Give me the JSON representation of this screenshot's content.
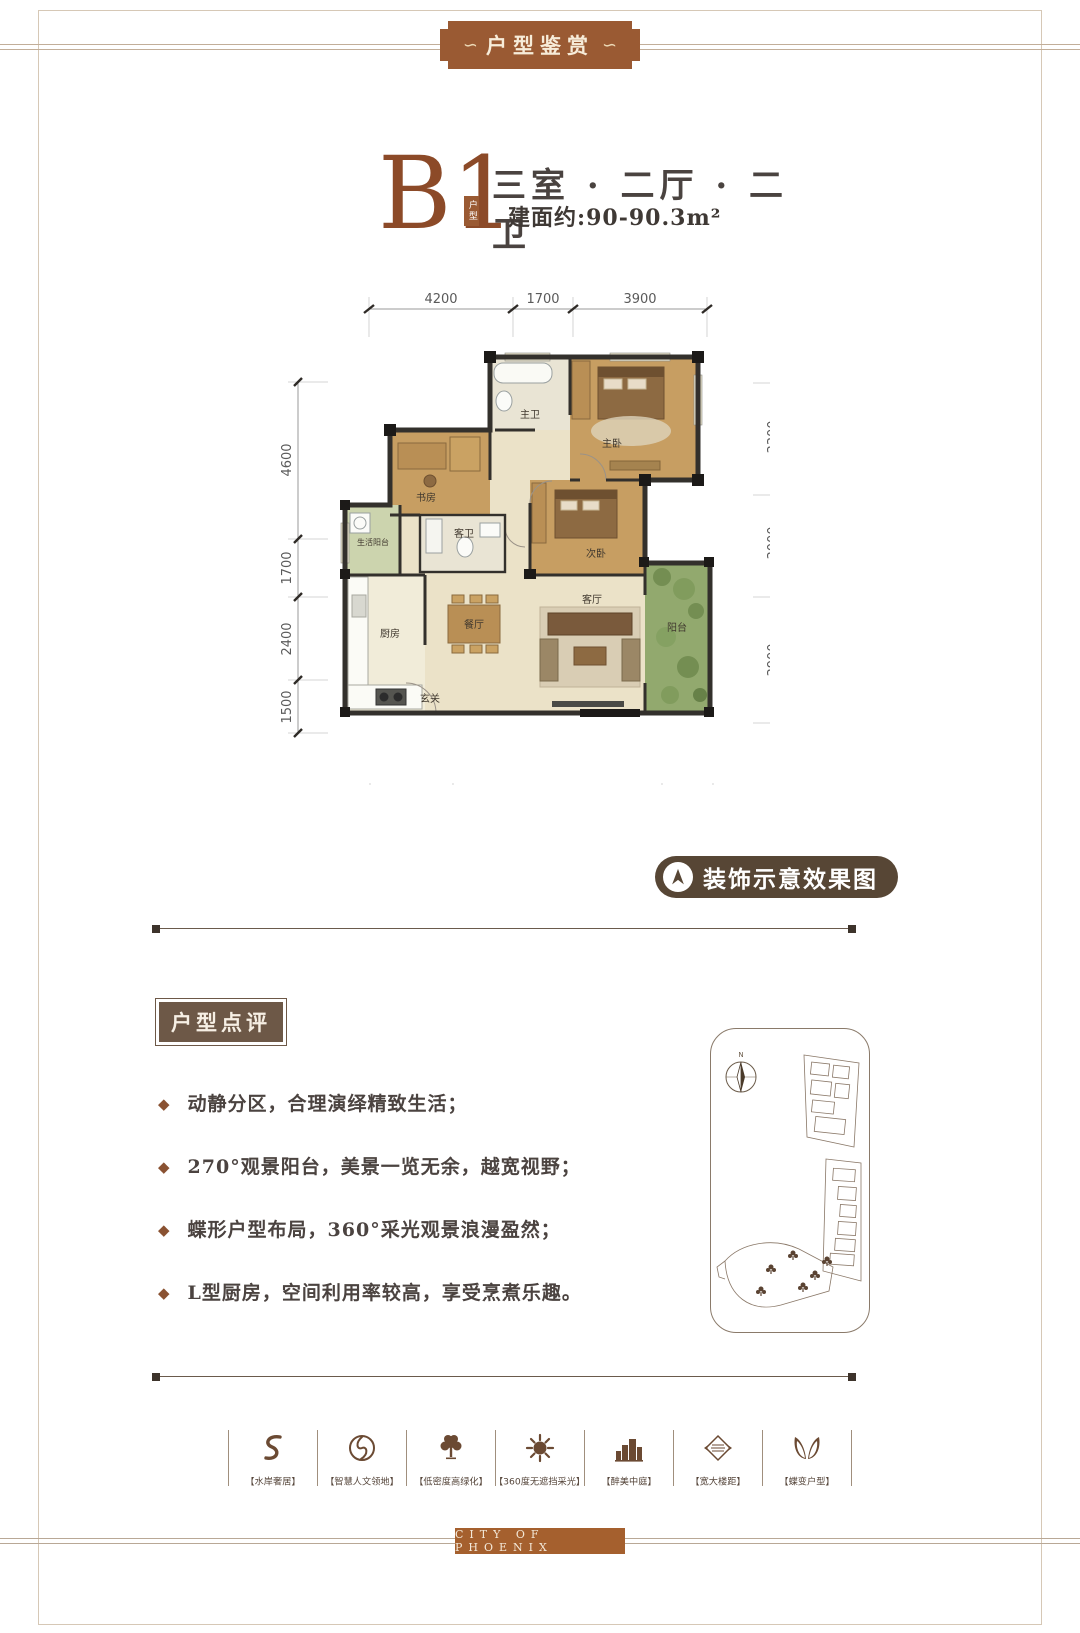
{
  "page": {
    "banner": "户型鉴赏",
    "banner_ornament": "∽",
    "footer_brand": "CITY OF PHOENIX"
  },
  "unit": {
    "code": "B1",
    "code_tag": "户型",
    "layout": "三室 · 二厅 · 二卫",
    "area": "建面约:90-90.3m²"
  },
  "floorplan": {
    "note_badge": "装饰示意效果图",
    "dims_top": [
      "4200",
      "1700",
      "3900"
    ],
    "dims_left": [
      "4600",
      "1700",
      "2400",
      "1500"
    ],
    "dims_right": [
      "3300",
      "3000",
      "3900"
    ],
    "dims_bottom": [
      "2400",
      "6100",
      "1500"
    ],
    "rooms": {
      "master_bath": "主卫",
      "master_bed": "主卧",
      "study": "书房",
      "second_bed": "次卧",
      "guest_bath": "客卫",
      "life_balcony": "生活阳台",
      "kitchen": "厨房",
      "dining": "餐厅",
      "living": "客厅",
      "balcony": "阳台",
      "foyer": "玄关"
    }
  },
  "review": {
    "title": "户型点评",
    "points": [
      "动静分区，合理演绎精致生活；",
      "270°观景阳台，美景一览无余，越宽视野；",
      "蝶形户型布局，360°采光观景浪漫盈然；",
      "L型厨房，空间利用率较高，享受烹煮乐趣。"
    ]
  },
  "sitemap": {
    "north_label": "N"
  },
  "features": {
    "items": [
      {
        "label": "【水岸奢居】",
        "icon": "water-swirl-icon"
      },
      {
        "label": "【智慧人文领地】",
        "icon": "culture-swirl-icon"
      },
      {
        "label": "【低密度高绿化】",
        "icon": "tree-icon"
      },
      {
        "label": "【360度无遮挡采光】",
        "icon": "sun-icon"
      },
      {
        "label": "【醉美中庭】",
        "icon": "courtyard-icon"
      },
      {
        "label": "【宽大楼距】",
        "icon": "building-spacing-icon"
      },
      {
        "label": "【蝶变户型】",
        "icon": "butterfly-icon"
      }
    ]
  },
  "colors": {
    "brand_copper": "#9a5a33",
    "title_brown": "#8c4a28",
    "badge_brown": "#574635",
    "review_brown": "#6d5847",
    "footer_copper": "#a5602e",
    "wood_floor": "#c79e62",
    "tile_floor": "#ebe2c8",
    "balcony_green": "#92a96e",
    "wall_dark": "#33302c"
  }
}
